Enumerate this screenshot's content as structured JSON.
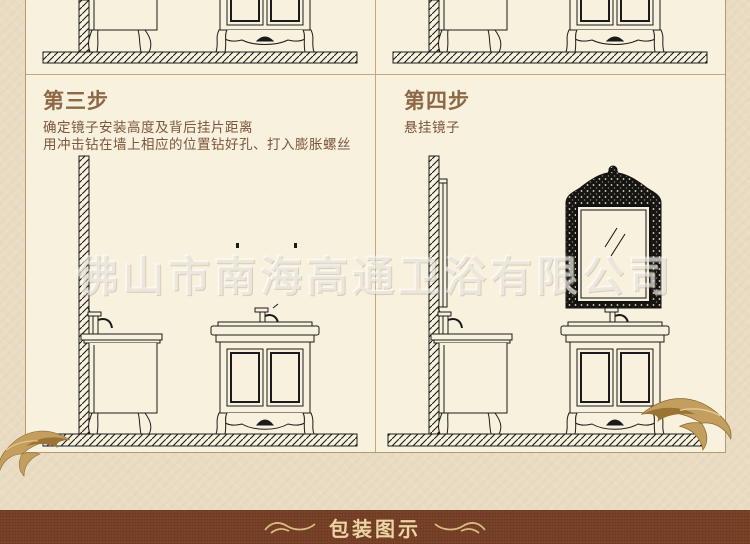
{
  "watermark": "佛山市南海高通卫浴有限公司",
  "steps": [
    {
      "title": "第三步",
      "lines": [
        "确定镜子安装高度及背后挂片距离",
        "用冲击钻在墙上相应的位置钻好孔、打入膨胀螺丝"
      ]
    },
    {
      "title": "第四步",
      "lines": [
        "悬挂镜子"
      ]
    }
  ],
  "footer": {
    "label": "包装图示"
  },
  "diagrams": {
    "top_left": "cropped-vanity-line-drawing",
    "top_right": "cropped-vanity-line-drawing",
    "step3": "wall-with-drill-holes-side-and-front-vanity",
    "step4": "ornate-mirror-hung-on-wall-above-vanity"
  },
  "icons": {
    "flourish_left": "gold-wing-flourish",
    "flourish_right": "gold-wing-flourish",
    "banner_swirl_left": "double-wave-ornament",
    "banner_swirl_right": "double-wave-ornament"
  },
  "colors": {
    "outer_bg": "#e9dcc3",
    "panel_bg": "#f8f1de",
    "frame_border": "#b59a6e",
    "divider": "#c4a97c",
    "step_title": "#8c6845",
    "step_text": "#7c553c",
    "drawing_line": "#1a1a1a",
    "banner_bg": "#7a4227",
    "banner_text": "#ecd5a4",
    "gold": "#c49e5e"
  }
}
